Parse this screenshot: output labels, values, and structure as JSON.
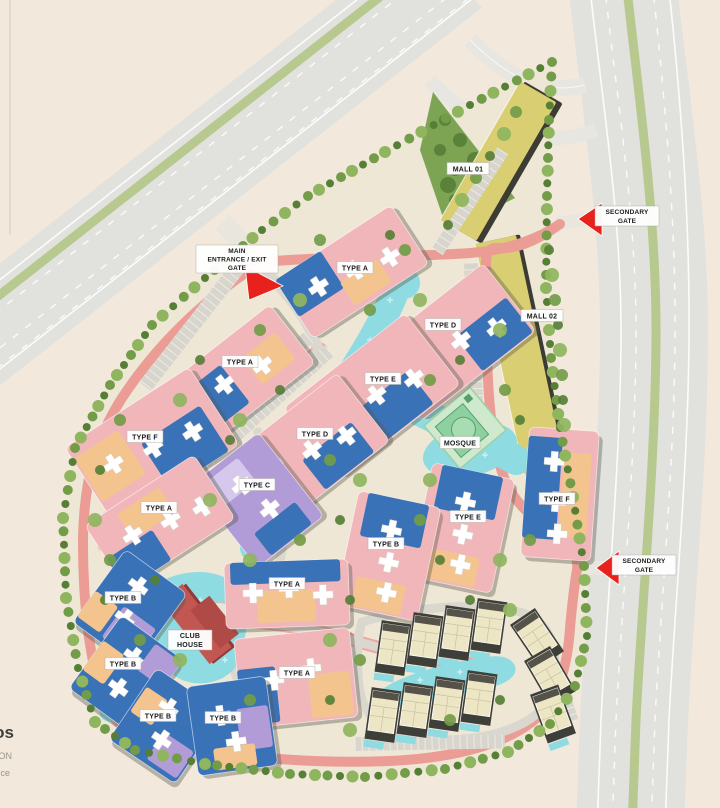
{
  "map": {
    "malls": [
      {
        "label": "MALL 01"
      },
      {
        "label": "MALL 02"
      }
    ],
    "mosque": {
      "label": "MOSQUE"
    },
    "club_house": {
      "line1": "CLUB",
      "line2": "HOUSE"
    },
    "gates": {
      "main": {
        "line1": "MAIN",
        "line2": "ENTRANCE / EXIT",
        "line3": "GATE"
      },
      "secondary_top": {
        "line1": "SECONDARY",
        "line2": "GATE"
      },
      "secondary_right": {
        "line1": "SECONDARY",
        "line2": "GATE"
      }
    },
    "building_labels": [
      {
        "label": "TYPE A"
      },
      {
        "label": "TYPE D"
      },
      {
        "label": "TYPE E"
      },
      {
        "label": "TYPE D"
      },
      {
        "label": "TYPE A"
      },
      {
        "label": "TYPE F"
      },
      {
        "label": "TYPE C"
      },
      {
        "label": "TYPE A"
      },
      {
        "label": "TYPE F"
      },
      {
        "label": "TYPE E"
      },
      {
        "label": "TYPE B"
      },
      {
        "label": "TYPE A"
      },
      {
        "label": "TYPE A"
      },
      {
        "label": "TYPE B"
      },
      {
        "label": "TYPE B"
      },
      {
        "label": "TYPE B"
      },
      {
        "label": "TYPE B"
      }
    ],
    "watermark": {
      "line1": "os",
      "line2": "ON",
      "line3": "ce"
    },
    "colors": {
      "background": "#f2e9dc",
      "site": "#efe7d6",
      "road": "#e1e1dd",
      "road_median": "#b7c98f",
      "ring_road": "#eb9d95",
      "water": "#8edbe1",
      "tree": "#739c48",
      "tree_dark": "#567f36",
      "tree_light": "#8fb55e",
      "building_pink": "#f1b6ba",
      "building_blue": "#3a72b8",
      "building_orange": "#f4c48e",
      "building_purple": "#b29cd8",
      "building_lavender": "#d6c8ec",
      "mall_yellow": "#d9cf72",
      "mosque_green": "#8fd0a0",
      "club_house_red": "#c25650",
      "villa_cream": "#ece6c4",
      "gate_arrow_red": "#e8211d",
      "label_bg": "#ffffff",
      "label_text": "#1a1a1a",
      "parking": "#d8d5cd"
    }
  }
}
